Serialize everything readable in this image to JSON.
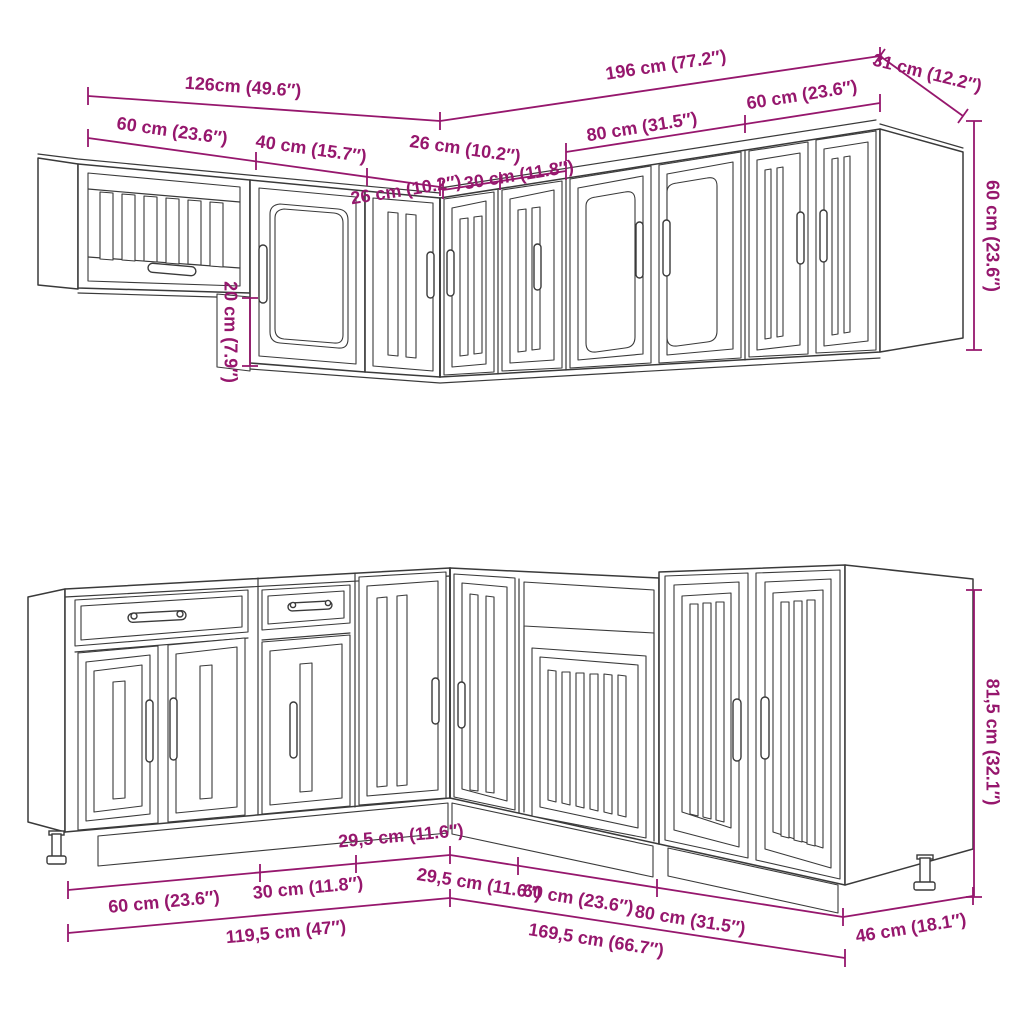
{
  "colors": {
    "dimension_annotation": "#96176D",
    "drawing_outline": "#3a3a3a",
    "background": "#ffffff"
  },
  "dimensions": {
    "top": {
      "total_left": "126cm (49.6″)",
      "total_right": "196 cm (77.2″)",
      "right_depth": "31 cm (12.2″)",
      "seg_60_left": "60 cm (23.6″)",
      "seg_40": "40 cm (15.7″)",
      "seg_26_left": "26 cm (10.2″)",
      "seg_26_right": "26 cm (10.2″)",
      "seg_30": "30 cm (11.8″)",
      "seg_80": "80 cm (31.5″)",
      "seg_60_right": "60 cm (23.6″)",
      "height": "60 cm (23.6″)",
      "drop": "20 cm (7.9″)"
    },
    "bottom": {
      "seg_60_left": "60 cm (23.6″)",
      "seg_30": "30 cm (11.8″)",
      "seg_295_left": "29,5 cm (11.6″)",
      "total_left": "119,5 cm (47″)",
      "seg_295_right": "29,5 cm (11.6″)",
      "seg_60_right": "60 cm (23.6″)",
      "seg_80": "80 cm (31.5″)",
      "total_right": "169,5 cm (66.7″)",
      "depth": "46 cm (18.1″)",
      "height": "81,5 cm (32.1″)"
    }
  }
}
